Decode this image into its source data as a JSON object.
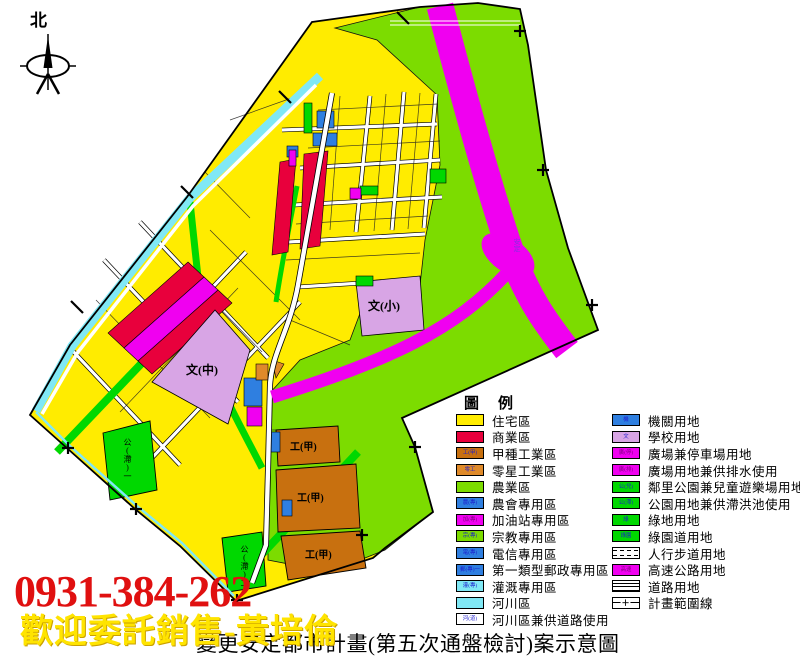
{
  "north_label": "北",
  "overlay": {
    "phone": "0931-384-262",
    "promo": "歡迎委託銷售-黃培倫"
  },
  "caption": "變更安定都市計畫(第五次通盤檢討)案示意圖",
  "legend": {
    "title": "圖　例",
    "left": [
      {
        "label": "住宅區",
        "code": ""
      },
      {
        "label": "商業區",
        "code": ""
      },
      {
        "label": "甲種工業區",
        "code": "工(甲)"
      },
      {
        "label": "零星工業區",
        "code": "零工"
      },
      {
        "label": "農業區",
        "code": ""
      },
      {
        "label": "農會專用區",
        "code": "農(專)"
      },
      {
        "label": "加油站專用區",
        "code": "加(專)"
      },
      {
        "label": "宗教專用區",
        "code": "宗(專)"
      },
      {
        "label": "電信專用區",
        "code": "電(專)"
      },
      {
        "label": "第一類型郵政專用區",
        "code": "郵(專)一"
      },
      {
        "label": "灌溉專用區",
        "code": "灌(專)"
      },
      {
        "label": "河川區",
        "code": ""
      },
      {
        "label": "河川區兼供道路使用",
        "code": "河(道)"
      }
    ],
    "right": [
      {
        "label": "機關用地",
        "code": "機"
      },
      {
        "label": "學校用地",
        "code": "文"
      },
      {
        "label": "廣場兼停車場用地",
        "code": "廣(停)"
      },
      {
        "label": "廣場用地兼供排水使用",
        "code": "廣(排)"
      },
      {
        "label": "鄰里公園兼兒童遊樂場用地",
        "code": "公(兒)"
      },
      {
        "label": "公園用地兼供滯洪池使用",
        "code": "公(滯)"
      },
      {
        "label": "綠地用地",
        "code": "綠"
      },
      {
        "label": "綠園道用地",
        "code": "綠園"
      },
      {
        "label": "人行步道用地",
        "code": ""
      },
      {
        "label": "高速公路用地",
        "code": "高速"
      },
      {
        "label": "道路用地",
        "code": ""
      },
      {
        "label": "計畫範圍線",
        "code": "＋"
      }
    ]
  },
  "map_labels": {
    "school_mid": "文(中)",
    "school_elem": "文(小)",
    "industrial": "工(甲)",
    "park1": "公(滯)一",
    "park2": "公(滯)二",
    "interchange": "安定"
  },
  "colors": {
    "residential": "#FFEC00",
    "commercial": "#E8003C",
    "industrial_a": "#C8700F",
    "industrial_scattered": "#DF8A2A",
    "agriculture": "#7CDC00",
    "park": "#00D800",
    "school": "#D8A5E5",
    "government": "#2F7FE0",
    "highway": "#F000F0",
    "river": "#80E8F5",
    "road": "#FFFFFF",
    "boundary": "#000000"
  }
}
